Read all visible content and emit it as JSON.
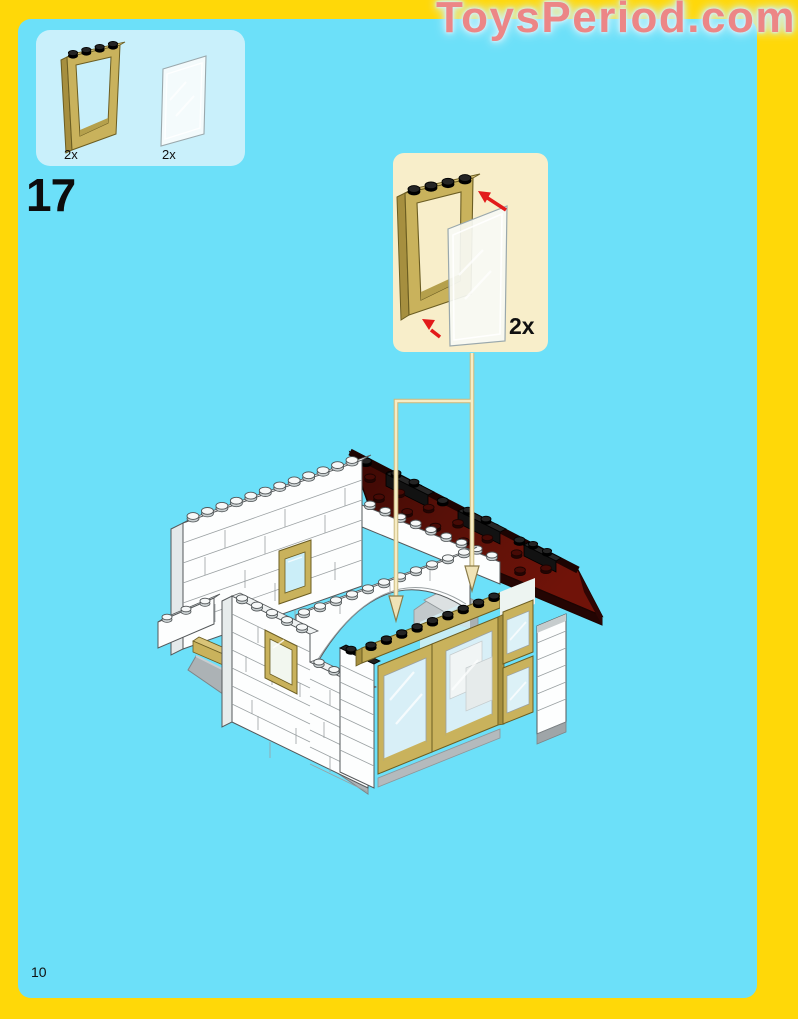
{
  "watermark": {
    "text": "ToysPeriod.com"
  },
  "step": {
    "number": "17"
  },
  "footer": {
    "page_number": "10"
  },
  "parts_callout": {
    "items": [
      {
        "part": "tan-window-frame-1x4x5",
        "quantity": "2x"
      },
      {
        "part": "clear-glass-panel-1x4x5",
        "quantity": "2x"
      }
    ]
  },
  "assembly_callout": {
    "quantity": "2x",
    "action": "insert clear glass panel into tan window frame"
  },
  "colors": {
    "border_yellow": "#FFD808",
    "background_cyan": "#6CE0F9",
    "parts_box_blue": "#C9F0FB",
    "callout_cream": "#F8EECA",
    "watermark_pink": "#EC8686",
    "watermark_glow": "#CDF2FC",
    "roof_dark_red": "#5C1009",
    "tan_frame": "#C9B25C",
    "white_brick": "#FDFEFE",
    "red_arrow": "#E21A1A",
    "connector_cream": "#F7ECC4",
    "base_gray": "#ACB2B5",
    "text_black": "#101010"
  }
}
